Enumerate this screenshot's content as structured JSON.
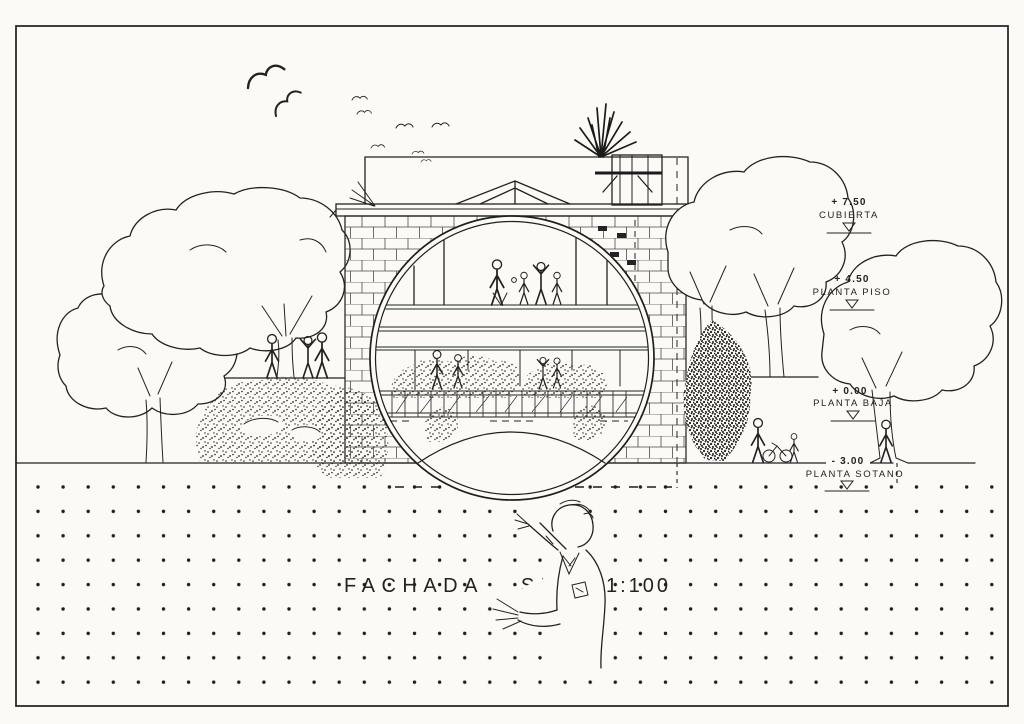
{
  "colors": {
    "ink": "#222220",
    "paper": "#fbfaf6"
  },
  "title": {
    "name": "FACHADA SUR",
    "scale": "1:100"
  },
  "levels": [
    {
      "value": "+ 7.50",
      "label": "CUBIERTA"
    },
    {
      "value": "+ 4.50",
      "label": "PLANTA PISO"
    },
    {
      "value": "+ 0.00",
      "label": "PLANTA BAJA"
    },
    {
      "value": "- 3.00",
      "label": "PLANTA SOTANO"
    }
  ]
}
